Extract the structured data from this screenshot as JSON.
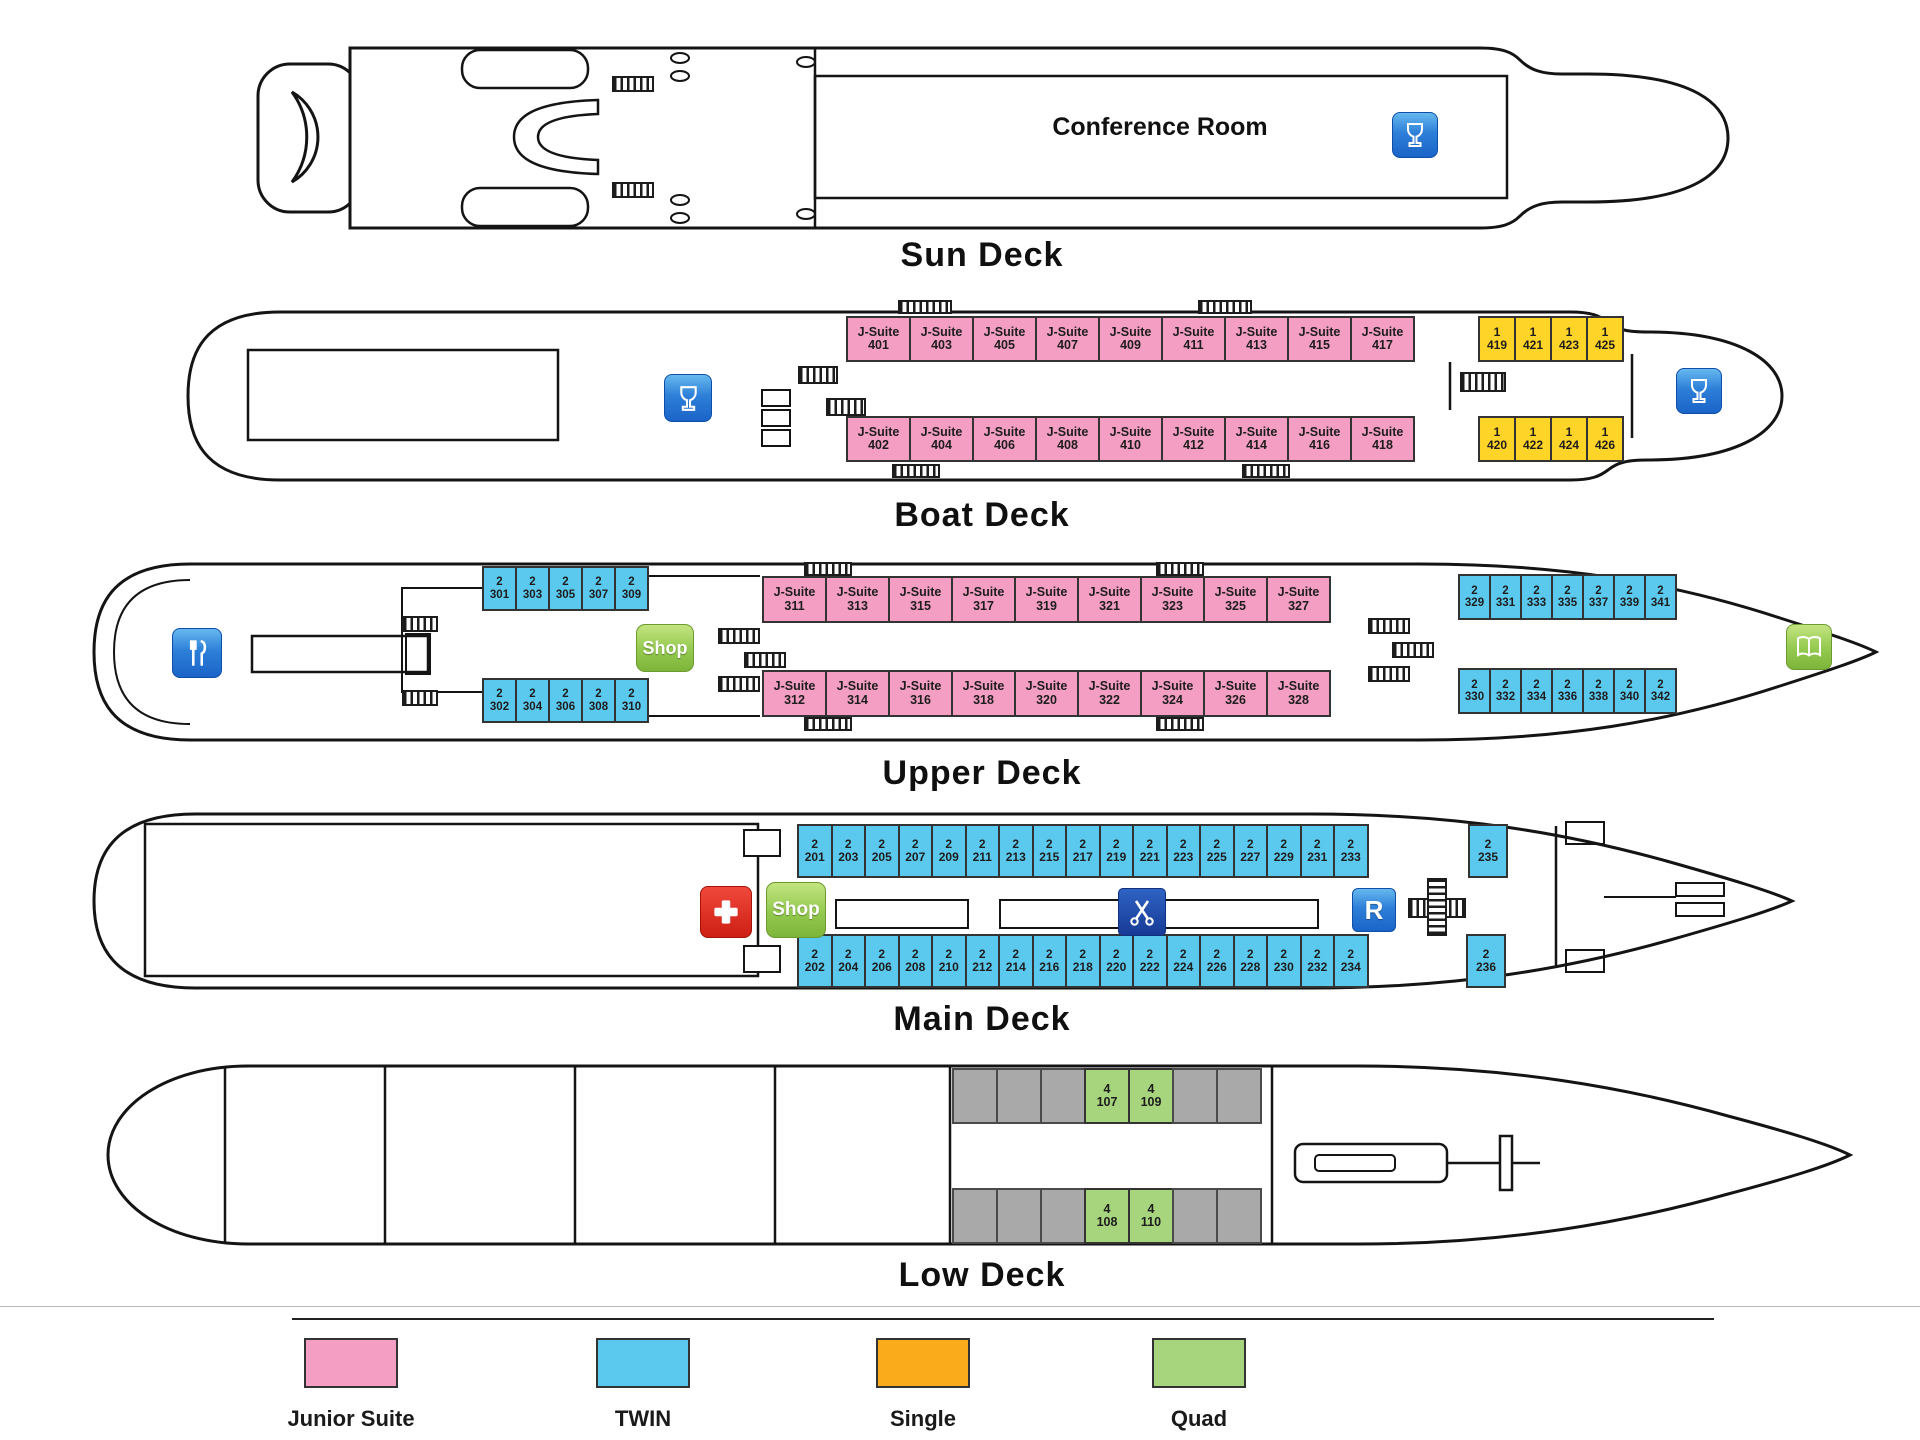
{
  "legend": {
    "items": [
      {
        "label": "Junior Suite",
        "color": "#F49EC3",
        "cls": "lg-junior"
      },
      {
        "label": "TWIN",
        "color": "#5BC9EE",
        "cls": "lg-twin"
      },
      {
        "label": "Single",
        "color": "#F9AB1B",
        "cls": "lg-single"
      },
      {
        "label": "Quad",
        "color": "#A7D57D",
        "cls": "lg-quad"
      }
    ]
  },
  "icons": {
    "bar": "wine-glass-icon",
    "restaurant": "fork-and-knife-icon",
    "shop_label": "Shop",
    "medical": "first-aid-cross-icon",
    "hairdresser": "scissors-icon",
    "reception_label": "R",
    "library": "open-book-icon",
    "stairs": "stairs-hatch-icon"
  },
  "decks": {
    "sun": {
      "label": "Sun Deck",
      "conference_room_label": "Conference Room"
    },
    "boat": {
      "label": "Boat Deck",
      "jsuite_top": [
        {
          "t": "J-Suite",
          "n": "401"
        },
        {
          "t": "J-Suite",
          "n": "403"
        },
        {
          "t": "J-Suite",
          "n": "405"
        },
        {
          "t": "J-Suite",
          "n": "407"
        },
        {
          "t": "J-Suite",
          "n": "409"
        },
        {
          "t": "J-Suite",
          "n": "411"
        },
        {
          "t": "J-Suite",
          "n": "413"
        },
        {
          "t": "J-Suite",
          "n": "415"
        },
        {
          "t": "J-Suite",
          "n": "417"
        }
      ],
      "jsuite_bottom": [
        {
          "t": "J-Suite",
          "n": "402"
        },
        {
          "t": "J-Suite",
          "n": "404"
        },
        {
          "t": "J-Suite",
          "n": "406"
        },
        {
          "t": "J-Suite",
          "n": "408"
        },
        {
          "t": "J-Suite",
          "n": "410"
        },
        {
          "t": "J-Suite",
          "n": "412"
        },
        {
          "t": "J-Suite",
          "n": "414"
        },
        {
          "t": "J-Suite",
          "n": "416"
        },
        {
          "t": "J-Suite",
          "n": "418"
        }
      ],
      "single_top": [
        {
          "t": "1",
          "n": "419"
        },
        {
          "t": "1",
          "n": "421"
        },
        {
          "t": "1",
          "n": "423"
        },
        {
          "t": "1",
          "n": "425"
        }
      ],
      "single_bottom": [
        {
          "t": "1",
          "n": "420"
        },
        {
          "t": "1",
          "n": "422"
        },
        {
          "t": "1",
          "n": "424"
        },
        {
          "t": "1",
          "n": "426"
        }
      ]
    },
    "upper": {
      "label": "Upper Deck",
      "twin_aft_top": [
        {
          "t": "2",
          "n": "301"
        },
        {
          "t": "2",
          "n": "303"
        },
        {
          "t": "2",
          "n": "305"
        },
        {
          "t": "2",
          "n": "307"
        },
        {
          "t": "2",
          "n": "309"
        }
      ],
      "twin_aft_bottom": [
        {
          "t": "2",
          "n": "302"
        },
        {
          "t": "2",
          "n": "304"
        },
        {
          "t": "2",
          "n": "306"
        },
        {
          "t": "2",
          "n": "308"
        },
        {
          "t": "2",
          "n": "310"
        }
      ],
      "jsuite_top": [
        {
          "t": "J-Suite",
          "n": "311"
        },
        {
          "t": "J-Suite",
          "n": "313"
        },
        {
          "t": "J-Suite",
          "n": "315"
        },
        {
          "t": "J-Suite",
          "n": "317"
        },
        {
          "t": "J-Suite",
          "n": "319"
        },
        {
          "t": "J-Suite",
          "n": "321"
        },
        {
          "t": "J-Suite",
          "n": "323"
        },
        {
          "t": "J-Suite",
          "n": "325"
        },
        {
          "t": "J-Suite",
          "n": "327"
        }
      ],
      "jsuite_bottom": [
        {
          "t": "J-Suite",
          "n": "312"
        },
        {
          "t": "J-Suite",
          "n": "314"
        },
        {
          "t": "J-Suite",
          "n": "316"
        },
        {
          "t": "J-Suite",
          "n": "318"
        },
        {
          "t": "J-Suite",
          "n": "320"
        },
        {
          "t": "J-Suite",
          "n": "322"
        },
        {
          "t": "J-Suite",
          "n": "324"
        },
        {
          "t": "J-Suite",
          "n": "326"
        },
        {
          "t": "J-Suite",
          "n": "328"
        }
      ],
      "twin_fwd_top": [
        {
          "t": "2",
          "n": "329"
        },
        {
          "t": "2",
          "n": "331"
        },
        {
          "t": "2",
          "n": "333"
        },
        {
          "t": "2",
          "n": "335"
        },
        {
          "t": "2",
          "n": "337"
        },
        {
          "t": "2",
          "n": "339"
        },
        {
          "t": "2",
          "n": "341"
        }
      ],
      "twin_fwd_bottom": [
        {
          "t": "2",
          "n": "330"
        },
        {
          "t": "2",
          "n": "332"
        },
        {
          "t": "2",
          "n": "334"
        },
        {
          "t": "2",
          "n": "336"
        },
        {
          "t": "2",
          "n": "338"
        },
        {
          "t": "2",
          "n": "340"
        },
        {
          "t": "2",
          "n": "342"
        }
      ]
    },
    "main": {
      "label": "Main Deck",
      "twin_top": [
        {
          "t": "2",
          "n": "201"
        },
        {
          "t": "2",
          "n": "203"
        },
        {
          "t": "2",
          "n": "205"
        },
        {
          "t": "2",
          "n": "207"
        },
        {
          "t": "2",
          "n": "209"
        },
        {
          "t": "2",
          "n": "211"
        },
        {
          "t": "2",
          "n": "213"
        },
        {
          "t": "2",
          "n": "215"
        },
        {
          "t": "2",
          "n": "217"
        },
        {
          "t": "2",
          "n": "219"
        },
        {
          "t": "2",
          "n": "221"
        },
        {
          "t": "2",
          "n": "223"
        },
        {
          "t": "2",
          "n": "225"
        },
        {
          "t": "2",
          "n": "227"
        },
        {
          "t": "2",
          "n": "229"
        },
        {
          "t": "2",
          "n": "231"
        },
        {
          "t": "2",
          "n": "233"
        }
      ],
      "twin_bottom": [
        {
          "t": "2",
          "n": "202"
        },
        {
          "t": "2",
          "n": "204"
        },
        {
          "t": "2",
          "n": "206"
        },
        {
          "t": "2",
          "n": "208"
        },
        {
          "t": "2",
          "n": "210"
        },
        {
          "t": "2",
          "n": "212"
        },
        {
          "t": "2",
          "n": "214"
        },
        {
          "t": "2",
          "n": "216"
        },
        {
          "t": "2",
          "n": "218"
        },
        {
          "t": "2",
          "n": "220"
        },
        {
          "t": "2",
          "n": "222"
        },
        {
          "t": "2",
          "n": "224"
        },
        {
          "t": "2",
          "n": "226"
        },
        {
          "t": "2",
          "n": "228"
        },
        {
          "t": "2",
          "n": "230"
        },
        {
          "t": "2",
          "n": "232"
        },
        {
          "t": "2",
          "n": "234"
        }
      ],
      "fore_top": {
        "t": "2",
        "n": "235"
      },
      "fore_bottom": {
        "t": "2",
        "n": "236"
      }
    },
    "low": {
      "label": "Low Deck",
      "cells_top": [
        {
          "cls": "gray",
          "t": "",
          "n": ""
        },
        {
          "cls": "gray",
          "t": "",
          "n": ""
        },
        {
          "cls": "gray",
          "t": "",
          "n": ""
        },
        {
          "cls": "quad",
          "t": "4",
          "n": "107"
        },
        {
          "cls": "quad",
          "t": "4",
          "n": "109"
        },
        {
          "cls": "gray",
          "t": "",
          "n": ""
        },
        {
          "cls": "gray",
          "t": "",
          "n": ""
        }
      ],
      "cells_bottom": [
        {
          "cls": "gray",
          "t": "",
          "n": ""
        },
        {
          "cls": "gray",
          "t": "",
          "n": ""
        },
        {
          "cls": "gray",
          "t": "",
          "n": ""
        },
        {
          "cls": "quad",
          "t": "4",
          "n": "108"
        },
        {
          "cls": "quad",
          "t": "4",
          "n": "110"
        },
        {
          "cls": "gray",
          "t": "",
          "n": ""
        },
        {
          "cls": "gray",
          "t": "",
          "n": ""
        }
      ]
    }
  }
}
